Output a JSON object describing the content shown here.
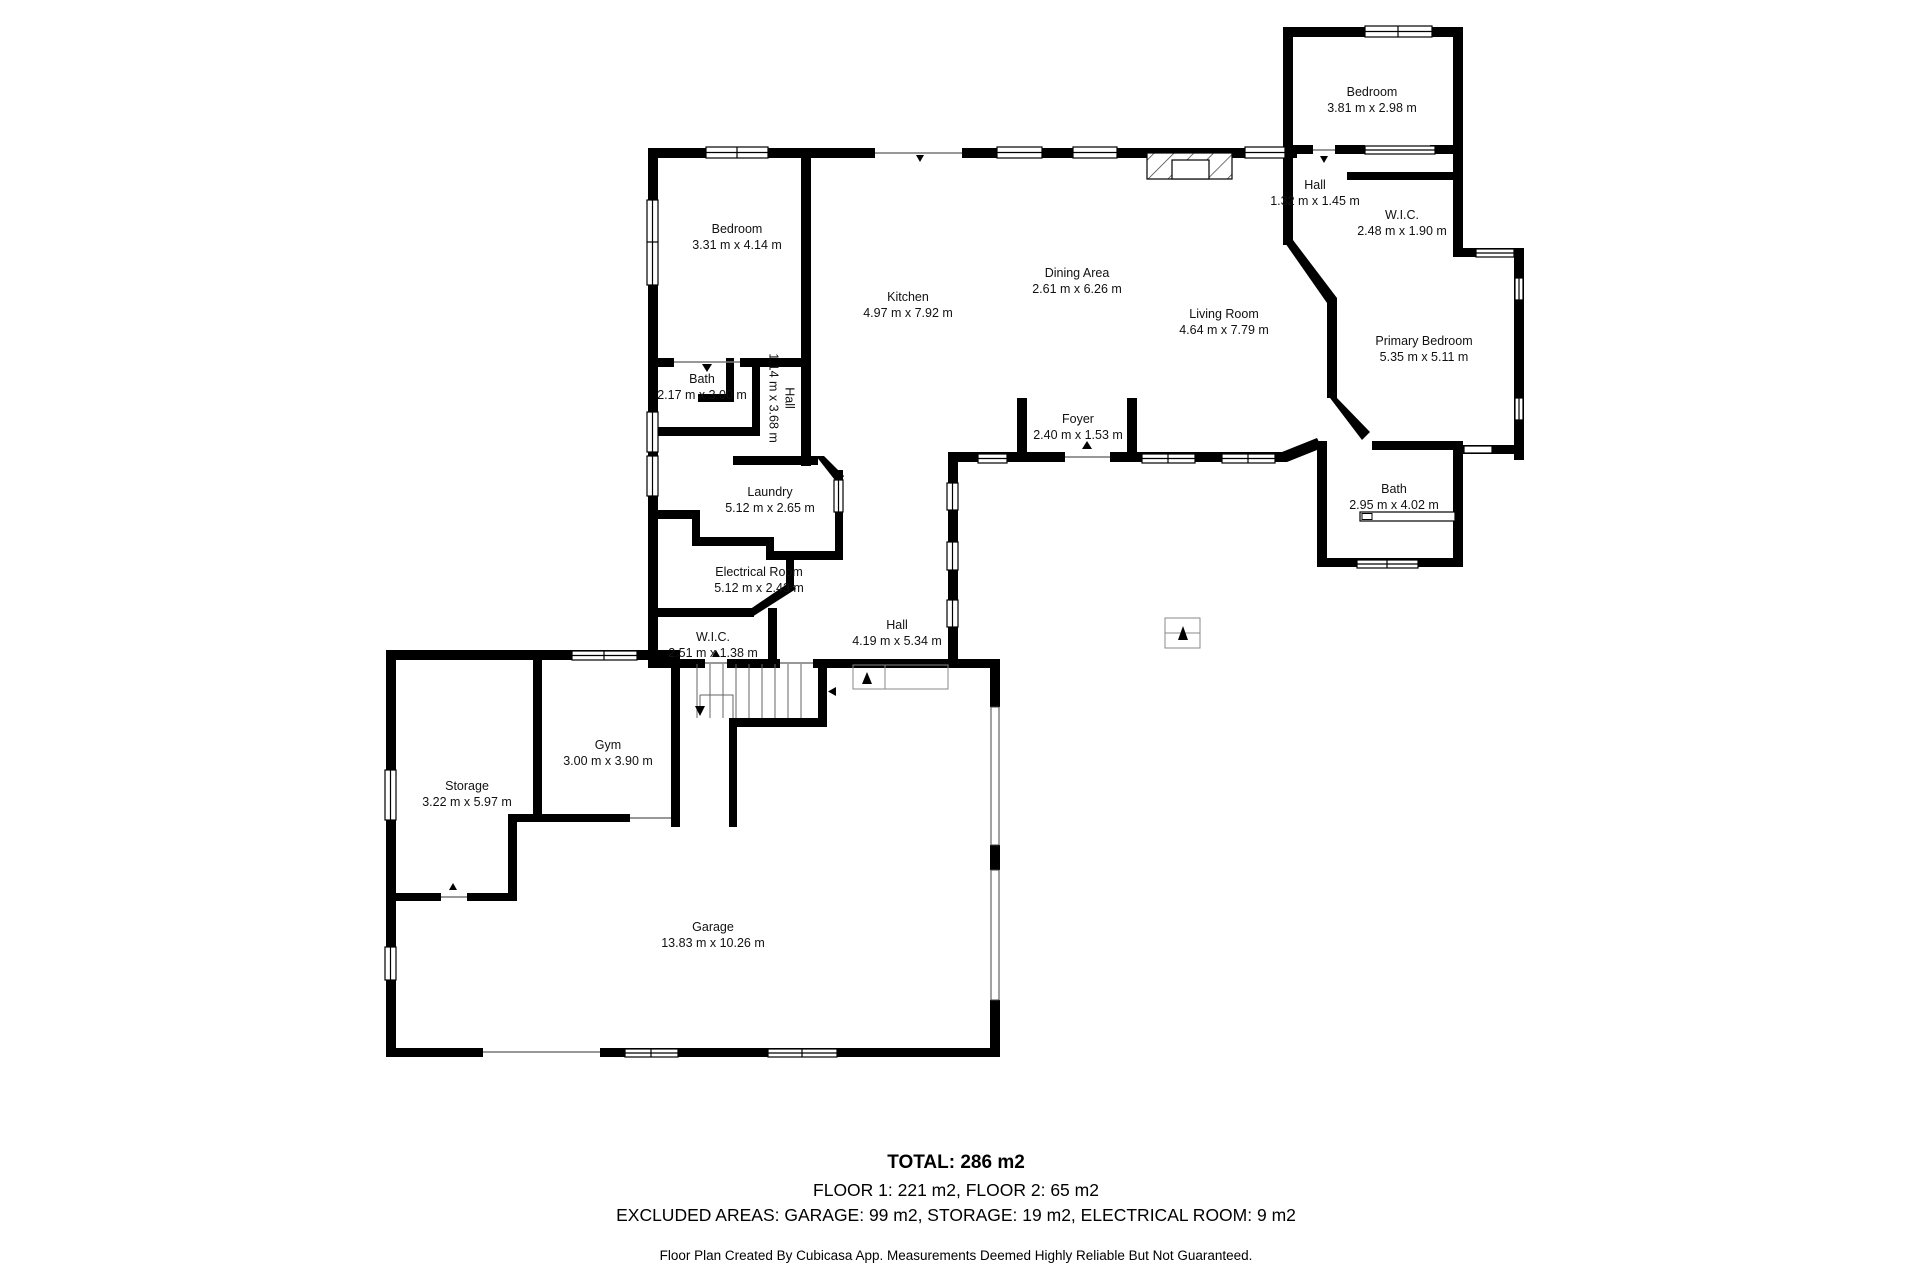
{
  "plan": {
    "rooms": [
      {
        "id": "bedroom-f2",
        "name": "Bedroom",
        "dims": "3.81 m x 2.98 m"
      },
      {
        "id": "hall-f2",
        "name": "Hall",
        "dims": "1.32 m x 1.45 m"
      },
      {
        "id": "wic-f2",
        "name": "W.I.C.",
        "dims": "2.48 m x 1.90 m"
      },
      {
        "id": "bedroom-f1",
        "name": "Bedroom",
        "dims": "3.31 m x 4.14 m"
      },
      {
        "id": "kitchen",
        "name": "Kitchen",
        "dims": "4.97 m x 7.92 m"
      },
      {
        "id": "dining-area",
        "name": "Dining Area",
        "dims": "2.61 m x 6.26 m"
      },
      {
        "id": "living-room",
        "name": "Living Room",
        "dims": "4.64 m x 7.79 m"
      },
      {
        "id": "primary-bedroom",
        "name": "Primary Bedroom",
        "dims": "5.35 m x 5.11 m"
      },
      {
        "id": "bath-f1",
        "name": "Bath",
        "dims": "2.17 m x 3.00 m"
      },
      {
        "id": "hall-corridor",
        "name": "Hall",
        "dims": "1.14 m x 3.68 m"
      },
      {
        "id": "foyer",
        "name": "Foyer",
        "dims": "2.40 m x 1.53 m"
      },
      {
        "id": "bath-primary",
        "name": "Bath",
        "dims": "2.95 m x 4.02 m"
      },
      {
        "id": "laundry",
        "name": "Laundry",
        "dims": "5.12 m x 2.65 m"
      },
      {
        "id": "electrical-room",
        "name": "Electrical Room",
        "dims": "5.12 m x 2.43 m"
      },
      {
        "id": "hall-f1",
        "name": "Hall",
        "dims": "4.19 m x 5.34 m"
      },
      {
        "id": "wic-f1",
        "name": "W.I.C.",
        "dims": "2.51 m x 1.38 m"
      },
      {
        "id": "gym",
        "name": "Gym",
        "dims": "3.00 m x 3.90 m"
      },
      {
        "id": "storage",
        "name": "Storage",
        "dims": "3.22 m x 5.97 m"
      },
      {
        "id": "garage",
        "name": "Garage",
        "dims": "13.83 m x 10.26 m"
      }
    ],
    "footer": {
      "total": "TOTAL: 286 m2",
      "floors": "FLOOR 1: 221 m2, FLOOR 2: 65 m2",
      "excluded": "EXCLUDED AREAS: GARAGE: 99 m2, STORAGE: 19 m2, ELECTRICAL ROOM: 9 m2",
      "disclaimer": "Floor Plan Created By Cubicasa App. Measurements Deemed Highly Reliable But Not Guaranteed."
    },
    "colors": {
      "wall": "#000000",
      "background": "#ffffff"
    }
  }
}
